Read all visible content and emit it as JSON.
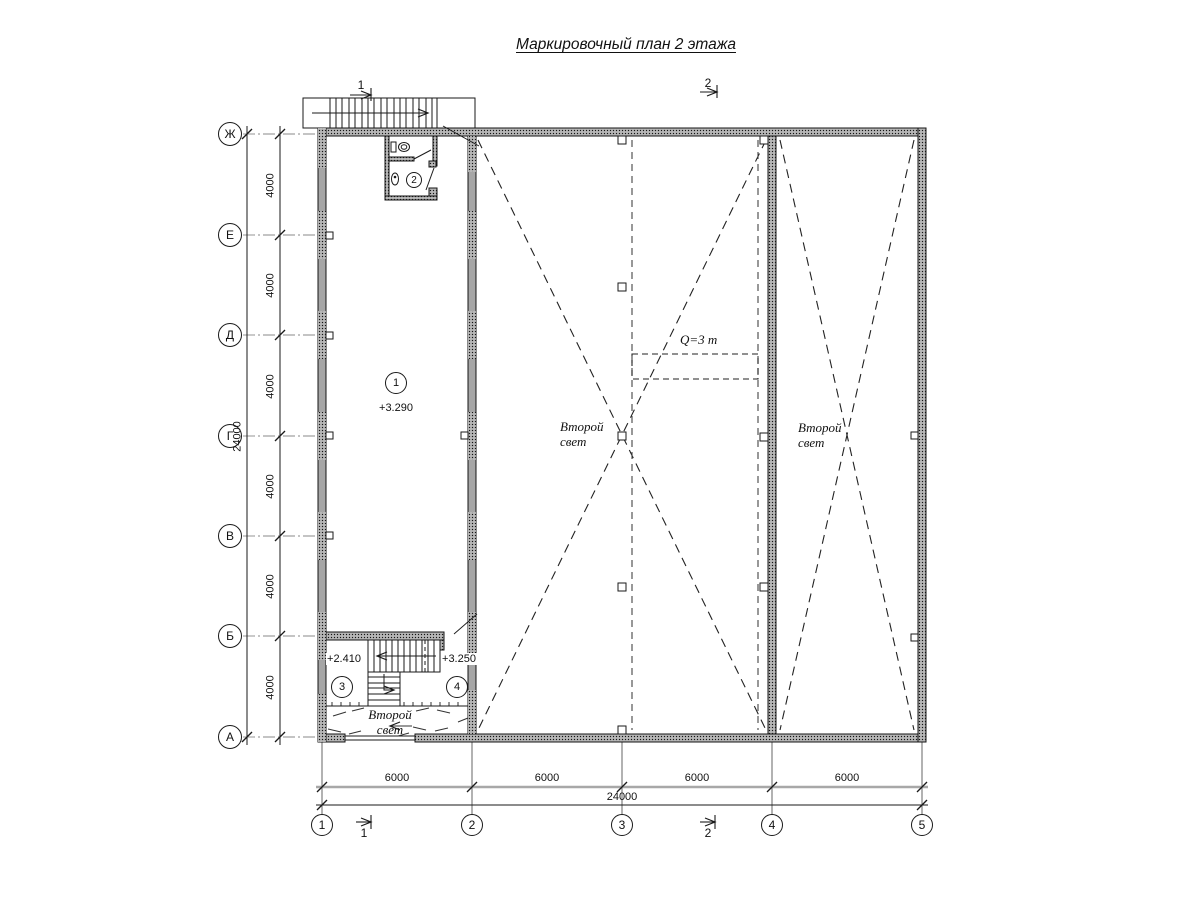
{
  "title": "Маркировочный план 2 этажа",
  "axes": {
    "rows": [
      "Ж",
      "Е",
      "Д",
      "Г",
      "В",
      "Б",
      "А"
    ],
    "cols": [
      "1",
      "2",
      "3",
      "4",
      "5"
    ]
  },
  "dimensions": {
    "left_total": "24000",
    "left_segment": "4000",
    "bottom_segment": "6000",
    "bottom_total": "24000"
  },
  "sections": {
    "one": "1",
    "two": "2"
  },
  "rooms": {
    "r1": {
      "num": "1",
      "elev": "+3.290"
    },
    "r2": {
      "num": "2"
    },
    "r3": {
      "num": "3",
      "elev": "+2.410"
    },
    "r4": {
      "num": "4",
      "elev": "+3.250"
    }
  },
  "annotations": {
    "second_light": "Второй свет",
    "crane": "Q=3 т"
  },
  "colors": {
    "line": "#1a1a1a",
    "wall_base": "#a6a6a6",
    "dim_band": "#a8a8a8"
  }
}
